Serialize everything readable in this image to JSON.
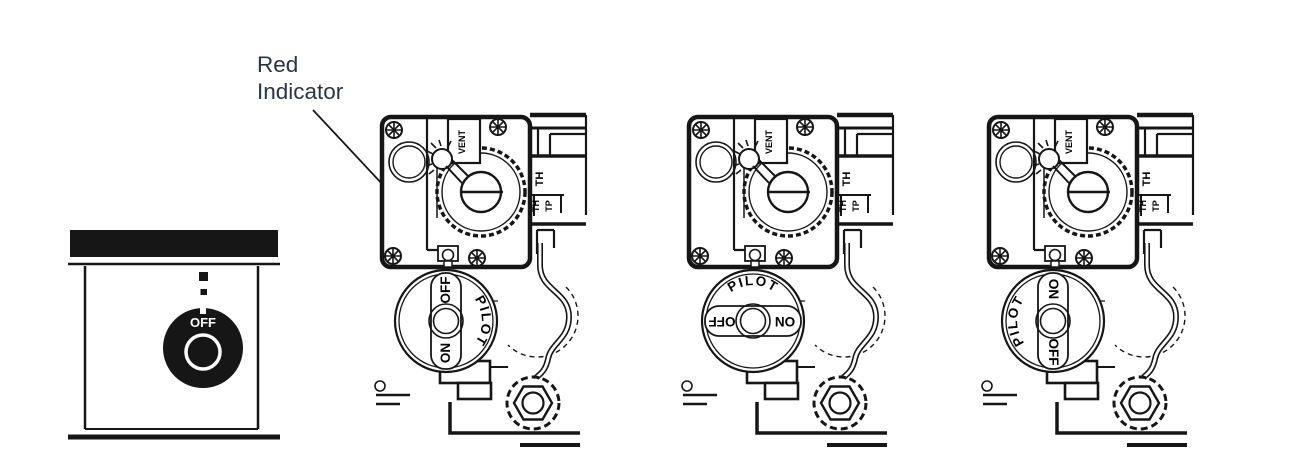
{
  "annotation": {
    "line1": "Red",
    "line2": "Indicator",
    "color": "#2b3444"
  },
  "front_panel": {
    "knob_label": "OFF",
    "state": "knob at OFF with dashed index marks above"
  },
  "valve": {
    "vent": "VENT",
    "th": "TH",
    "th2": "TH",
    "tp": "TP",
    "knob": {
      "off": "OFF",
      "on": "ON",
      "pilot": "PILOT"
    }
  },
  "valves": [
    {
      "position": "OFF",
      "knob_rotation_deg": 0
    },
    {
      "position": "PILOT",
      "knob_rotation_deg": -90
    },
    {
      "position": "ON",
      "knob_rotation_deg": 180
    }
  ],
  "colors": {
    "ink": "#161616",
    "background": "#ffffff",
    "panel_knob_fill": "#161616",
    "panel_knob_text": "#ffffff"
  }
}
